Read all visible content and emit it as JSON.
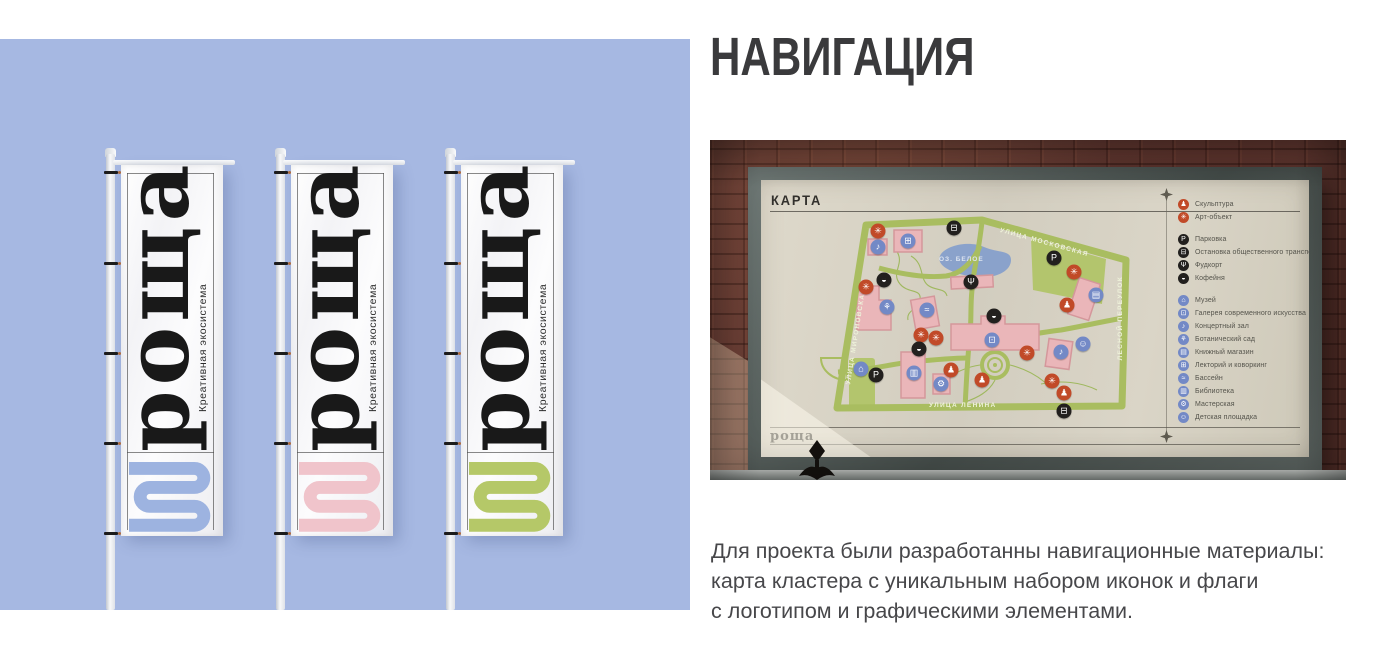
{
  "header": {
    "title": "НАВИГАЦИЯ"
  },
  "caption": {
    "text": "Для проекта были разработанны навигационные материалы:\nкарта кластера с уникальным набором иконок и флаги\nс логотипом и графическими элементами."
  },
  "left_panel": {
    "bg_color": "#a6b8e2",
    "flags": [
      {
        "logo": "роща",
        "tagline": "Креативная экосистема",
        "accent_color": "#9db3e0"
      },
      {
        "logo": "роща",
        "tagline": "Креативная экосистема",
        "accent_color": "#f0c4cb"
      },
      {
        "logo": "роща",
        "tagline": "Креативная экосистема",
        "accent_color": "#b5c868"
      }
    ]
  },
  "photo": {
    "board": {
      "title": "КАРТА",
      "logo": "роща",
      "legend": {
        "groups": [
          {
            "color": "#c14a28",
            "items": [
              {
                "icon": "sculpture-icon",
                "glyph": "♟",
                "label": "Скульптура"
              },
              {
                "icon": "art-object-icon",
                "glyph": "✳",
                "label": "Арт-объект"
              }
            ]
          },
          {
            "color": "#22201e",
            "items": [
              {
                "icon": "parking-icon",
                "glyph": "P",
                "label": "Парковка"
              },
              {
                "icon": "bus-stop-icon",
                "glyph": "⊟",
                "label": "Остановка общественного транспорта"
              },
              {
                "icon": "food-court-icon",
                "glyph": "Ψ",
                "label": "Фудкорт"
              },
              {
                "icon": "coffee-icon",
                "glyph": "◒",
                "label": "Кофейня"
              }
            ]
          },
          {
            "color": "#7389c6",
            "items": [
              {
                "icon": "museum-icon",
                "glyph": "⌂",
                "label": "Музей"
              },
              {
                "icon": "gallery-icon",
                "glyph": "⊡",
                "label": "Галерея современного искусства"
              },
              {
                "icon": "concert-hall-icon",
                "glyph": "♪",
                "label": "Концертный зал"
              },
              {
                "icon": "botanical-garden-icon",
                "glyph": "⚘",
                "label": "Ботанический сад"
              },
              {
                "icon": "bookstore-icon",
                "glyph": "▤",
                "label": "Книжный магазин"
              },
              {
                "icon": "lecture-coworking-icon",
                "glyph": "⊞",
                "label": "Лекторий и коворкинг"
              },
              {
                "icon": "pool-icon",
                "glyph": "≈",
                "label": "Бассейн"
              },
              {
                "icon": "library-icon",
                "glyph": "▥",
                "label": "Библиотека"
              },
              {
                "icon": "workshop-icon",
                "glyph": "⚙",
                "label": "Мастерская"
              },
              {
                "icon": "playground-icon",
                "glyph": "☺",
                "label": "Детская площадка"
              }
            ]
          }
        ]
      },
      "map": {
        "lake_label": "ОЗ. БЕЛОЕ",
        "street_labels": [
          "УЛИЦА МОСКОВСКАЯ",
          "ЛЕСНОЙ ПЕРЕУЛОК",
          "УЛИЦА ЛЕНИНА",
          "УЛИЦА МИРОНОВСКАЯ"
        ],
        "icons": [
          {
            "icon": "art-object-icon",
            "glyph": "✳",
            "color": "#c14a28",
            "x": 117,
            "y": 19
          },
          {
            "icon": "art-object-icon",
            "glyph": "✳",
            "color": "#c14a28",
            "x": 105,
            "y": 75
          },
          {
            "icon": "art-object-icon",
            "glyph": "✳",
            "color": "#c14a28",
            "x": 313,
            "y": 60
          },
          {
            "icon": "art-object-icon",
            "glyph": "✳",
            "color": "#c14a28",
            "x": 160,
            "y": 123
          },
          {
            "icon": "art-object-icon",
            "glyph": "✳",
            "color": "#c14a28",
            "x": 175,
            "y": 126
          },
          {
            "icon": "art-object-icon",
            "glyph": "✳",
            "color": "#c14a28",
            "x": 266,
            "y": 141
          },
          {
            "icon": "art-object-icon",
            "glyph": "✳",
            "color": "#c14a28",
            "x": 291,
            "y": 169
          },
          {
            "icon": "sculpture-icon",
            "glyph": "♟",
            "color": "#c14a28",
            "x": 306,
            "y": 93
          },
          {
            "icon": "sculpture-icon",
            "glyph": "♟",
            "color": "#c14a28",
            "x": 190,
            "y": 158
          },
          {
            "icon": "sculpture-icon",
            "glyph": "♟",
            "color": "#c14a28",
            "x": 221,
            "y": 168
          },
          {
            "icon": "sculpture-icon",
            "glyph": "♟",
            "color": "#c14a28",
            "x": 303,
            "y": 181
          },
          {
            "icon": "parking-icon",
            "glyph": "P",
            "color": "#22201e",
            "x": 293,
            "y": 46
          },
          {
            "icon": "parking-icon",
            "glyph": "P",
            "color": "#22201e",
            "x": 115,
            "y": 163
          },
          {
            "icon": "bus-stop-icon",
            "glyph": "⊟",
            "color": "#22201e",
            "x": 193,
            "y": 16
          },
          {
            "icon": "bus-stop-icon",
            "glyph": "⊟",
            "color": "#22201e",
            "x": 303,
            "y": 199
          },
          {
            "icon": "coffee-icon",
            "glyph": "◒",
            "color": "#22201e",
            "x": 123,
            "y": 68
          },
          {
            "icon": "coffee-icon",
            "glyph": "◒",
            "color": "#22201e",
            "x": 158,
            "y": 137
          },
          {
            "icon": "coffee-icon",
            "glyph": "◒",
            "color": "#22201e",
            "x": 233,
            "y": 104
          },
          {
            "icon": "food-court-icon",
            "glyph": "Ψ",
            "color": "#22201e",
            "x": 210,
            "y": 70
          },
          {
            "icon": "lecture-coworking-icon",
            "glyph": "⊞",
            "color": "#7389c6",
            "x": 147,
            "y": 29
          },
          {
            "icon": "concert-hall-icon",
            "glyph": "♪",
            "color": "#7389c6",
            "x": 117,
            "y": 35
          },
          {
            "icon": "botanical-garden-icon",
            "glyph": "⚘",
            "color": "#7389c6",
            "x": 126,
            "y": 95
          },
          {
            "icon": "pool-icon",
            "glyph": "≈",
            "color": "#7389c6",
            "x": 166,
            "y": 98
          },
          {
            "icon": "gallery-icon",
            "glyph": "⊡",
            "color": "#7389c6",
            "x": 231,
            "y": 128
          },
          {
            "icon": "library-icon",
            "glyph": "▥",
            "color": "#7389c6",
            "x": 153,
            "y": 161
          },
          {
            "icon": "workshop-icon",
            "glyph": "⚙",
            "color": "#7389c6",
            "x": 180,
            "y": 172
          },
          {
            "icon": "museum-icon",
            "glyph": "⌂",
            "color": "#7389c6",
            "x": 100,
            "y": 157
          },
          {
            "icon": "bookstore-icon",
            "glyph": "▤",
            "color": "#7389c6",
            "x": 335,
            "y": 83
          },
          {
            "icon": "concert-hall-icon",
            "glyph": "♪",
            "color": "#7389c6",
            "x": 300,
            "y": 140
          },
          {
            "icon": "playground-icon",
            "glyph": "☺",
            "color": "#7389c6",
            "x": 322,
            "y": 132
          }
        ]
      }
    }
  },
  "colors": {
    "street": "#a9bd60",
    "park": "#b3c56d",
    "lake": "#8aa2cb",
    "building": "#eab6b9"
  }
}
